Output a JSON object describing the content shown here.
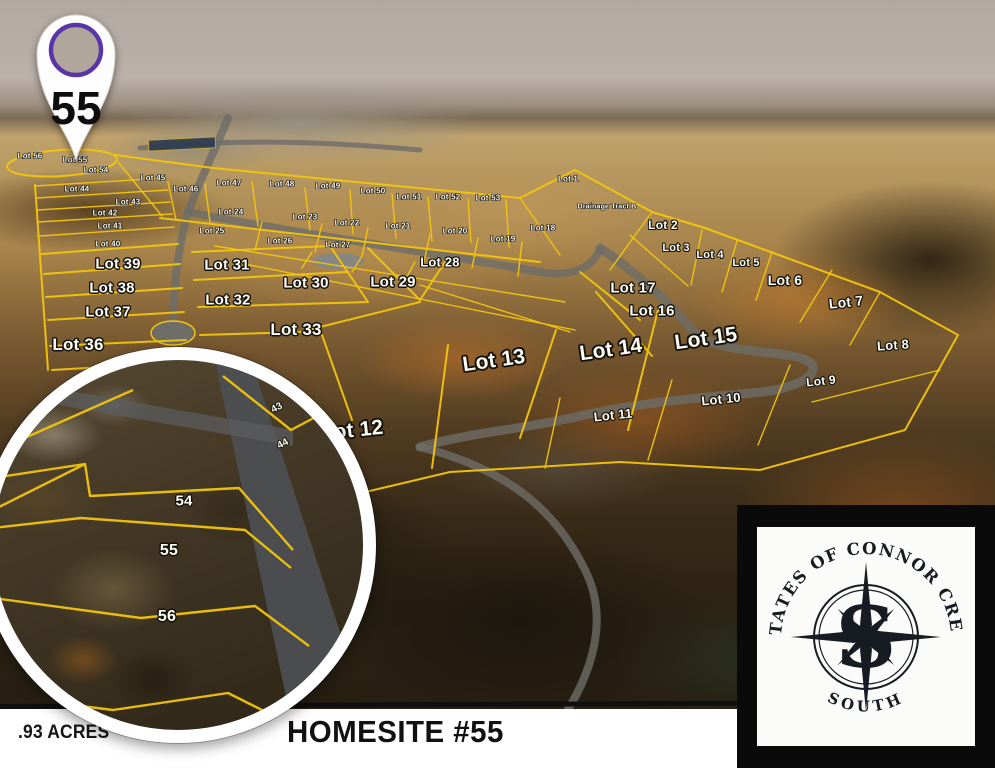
{
  "scene": {
    "marker": {
      "number": "55"
    },
    "footer": {
      "acreage": ".93 ACRES",
      "homesite": "HOMESITE #55"
    },
    "logo": {
      "arc_text": "ESTATES OF CONNOR CREEK",
      "south": "SOUTH",
      "monogram": "S"
    },
    "colors": {
      "lot_line": "#f2c50e",
      "pin_ring": "#5a35a8",
      "footer_ink": "#161616",
      "logo_ink": "#171b22"
    }
  },
  "map": {
    "lots": [
      {
        "label": "Lot 56",
        "x": 30,
        "y": 156,
        "size": 8
      },
      {
        "label": "Lot 55",
        "x": 75,
        "y": 160,
        "size": 8
      },
      {
        "label": "Lot 54",
        "x": 96,
        "y": 170,
        "size": 8
      },
      {
        "label": "Lot 45",
        "x": 153,
        "y": 178,
        "size": 8
      },
      {
        "label": "Lot 46",
        "x": 186,
        "y": 189,
        "size": 8
      },
      {
        "label": "Lot 47",
        "x": 229,
        "y": 183,
        "size": 8
      },
      {
        "label": "Lot 48",
        "x": 282,
        "y": 184,
        "size": 8
      },
      {
        "label": "Lot 49",
        "x": 328,
        "y": 186,
        "size": 8
      },
      {
        "label": "Lot 50",
        "x": 373,
        "y": 191,
        "size": 8
      },
      {
        "label": "Lot 51",
        "x": 409,
        "y": 197,
        "size": 8
      },
      {
        "label": "Lot 52",
        "x": 448,
        "y": 197,
        "size": 8
      },
      {
        "label": "Lot 53",
        "x": 488,
        "y": 198,
        "size": 8
      },
      {
        "label": "Lot 1",
        "x": 568,
        "y": 179,
        "size": 8
      },
      {
        "label": "Lot 44",
        "x": 77,
        "y": 189,
        "size": 8
      },
      {
        "label": "Lot 43",
        "x": 128,
        "y": 202,
        "size": 8
      },
      {
        "label": "Lot 42",
        "x": 105,
        "y": 213,
        "size": 8
      },
      {
        "label": "Lot 41",
        "x": 110,
        "y": 226,
        "size": 8
      },
      {
        "label": "Lot 40",
        "x": 108,
        "y": 244,
        "size": 8
      },
      {
        "label": "Lot 24",
        "x": 231,
        "y": 212,
        "size": 8
      },
      {
        "label": "Lot 25",
        "x": 212,
        "y": 231,
        "size": 8
      },
      {
        "label": "Lot 23",
        "x": 305,
        "y": 217,
        "size": 8
      },
      {
        "label": "Lot 22",
        "x": 347,
        "y": 223,
        "size": 8
      },
      {
        "label": "Lot 21",
        "x": 398,
        "y": 226,
        "size": 8
      },
      {
        "label": "Lot 20",
        "x": 455,
        "y": 231,
        "size": 8
      },
      {
        "label": "Lot 19",
        "x": 503,
        "y": 239,
        "size": 8
      },
      {
        "label": "Lot 18",
        "x": 543,
        "y": 228,
        "size": 8
      },
      {
        "label": "Lot 26",
        "x": 280,
        "y": 241,
        "size": 8
      },
      {
        "label": "Lot 27",
        "x": 338,
        "y": 245,
        "size": 8
      },
      {
        "label": "Lot 39",
        "x": 118,
        "y": 264,
        "size": 15
      },
      {
        "label": "Lot 38",
        "x": 112,
        "y": 288,
        "size": 15
      },
      {
        "label": "Lot 37",
        "x": 108,
        "y": 312,
        "size": 15
      },
      {
        "label": "Lot 36",
        "x": 78,
        "y": 345,
        "size": 17
      },
      {
        "label": "Lot 31",
        "x": 227,
        "y": 265,
        "size": 15
      },
      {
        "label": "Lot 32",
        "x": 228,
        "y": 300,
        "size": 15
      },
      {
        "label": "Lot 30",
        "x": 306,
        "y": 283,
        "size": 15
      },
      {
        "label": "Lot 33",
        "x": 296,
        "y": 330,
        "size": 17
      },
      {
        "label": "Lot 29",
        "x": 393,
        "y": 282,
        "size": 15
      },
      {
        "label": "Lot 28",
        "x": 440,
        "y": 262,
        "size": 13
      },
      {
        "label": "Lot 17",
        "x": 633,
        "y": 288,
        "size": 15
      },
      {
        "label": "Lot 16",
        "x": 652,
        "y": 311,
        "size": 15
      },
      {
        "label": "Lot 2",
        "x": 663,
        "y": 225,
        "size": 12
      },
      {
        "label": "Lot 3",
        "x": 676,
        "y": 248,
        "size": 11
      },
      {
        "label": "Lot 4",
        "x": 710,
        "y": 255,
        "size": 11
      },
      {
        "label": "Lot 5",
        "x": 746,
        "y": 263,
        "size": 11
      },
      {
        "label": "Lot 6",
        "x": 785,
        "y": 280,
        "size": 14
      },
      {
        "label": "Lot 7",
        "x": 846,
        "y": 302,
        "size": 14,
        "rot": -6
      },
      {
        "label": "Lot 8",
        "x": 893,
        "y": 345,
        "size": 13,
        "rot": -4
      },
      {
        "label": "Lot 9",
        "x": 821,
        "y": 381,
        "size": 12,
        "rot": -6
      },
      {
        "label": "Lot 10",
        "x": 721,
        "y": 399,
        "size": 13,
        "rot": -6
      },
      {
        "label": "Lot 11",
        "x": 613,
        "y": 415,
        "size": 13,
        "rot": -6
      },
      {
        "label": "Lot 13",
        "x": 494,
        "y": 361,
        "size": 21,
        "rot": -8
      },
      {
        "label": "Lot 14",
        "x": 611,
        "y": 350,
        "size": 21,
        "rot": -8
      },
      {
        "label": "Lot 15",
        "x": 706,
        "y": 339,
        "size": 21,
        "rot": -8
      },
      {
        "label": "Lot 12",
        "x": 352,
        "y": 431,
        "size": 21,
        "rot": -6
      },
      {
        "label": "Drainage Tract B",
        "x": 607,
        "y": 207,
        "size": 7
      }
    ]
  },
  "inset": {
    "lots": [
      {
        "label": "54",
        "x": 191,
        "y": 141,
        "size": 15
      },
      {
        "label": "55",
        "x": 176,
        "y": 191,
        "size": 16
      },
      {
        "label": "56",
        "x": 174,
        "y": 257,
        "size": 16
      },
      {
        "label": "44",
        "x": 290,
        "y": 84,
        "size": 10,
        "rot": -28
      },
      {
        "label": "43",
        "x": 284,
        "y": 48,
        "size": 10,
        "rot": -28
      }
    ]
  }
}
